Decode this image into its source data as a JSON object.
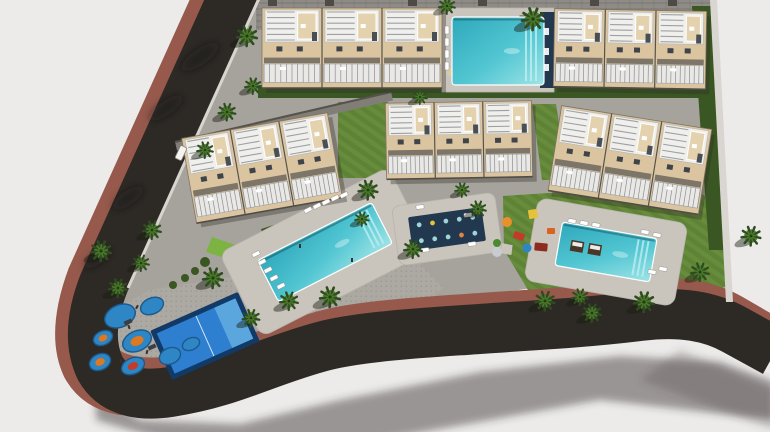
{
  "meta": {
    "canvas": {
      "w": 770,
      "h": 432
    },
    "subject": "aerial-3d-render-residential-complex"
  },
  "scene": {
    "colors": {
      "bg": "#ECEBE9",
      "road": "#2D2925",
      "sidewalk": "#96594C",
      "curb": "#D8D4CE",
      "paving": "#A6A29C",
      "plaza": "#ACA8A2",
      "deck": "#C9C5BD",
      "roofband": "#8F8B86",
      "facade": "#DBC5A1",
      "facadeLight": "#E4D2AF",
      "roofdeck": "#F0EFEB",
      "stripe": "#9BA1A6",
      "windowc": "#3F444A",
      "railing": "#E9E8E4",
      "lawn": "#5E8236",
      "lawnLight": "#6E9440",
      "lawnBright": "#7CB342",
      "hedge": "#3A5622",
      "palmDark": "#2E4D1F",
      "palmLight": "#4C7A2B",
      "waterDeep": "#2FA8BC",
      "waterMid": "#52C6D2",
      "waterLight": "#9FE4E6",
      "navy": "#22384E",
      "courtBlue": "#2E7FD0",
      "courtFrame": "#123A66",
      "courtLight": "#5CA6DE",
      "circleBlue": "#2F86C4",
      "wall": "#D9D6D1",
      "shadow": "rgba(50,46,42,0.45)",
      "kiosk": "#6F4A2E",
      "platform": "#4A3726"
    },
    "buildings": [
      {
        "id": "top-left",
        "cx": 352,
        "cy": 48,
        "w": 180,
        "h": 80,
        "rot": 0,
        "modules": 3
      },
      {
        "id": "top-right",
        "cx": 630,
        "cy": 49,
        "w": 152,
        "h": 78,
        "rot": 1,
        "modules": 3
      },
      {
        "id": "mid-left",
        "cx": 262,
        "cy": 168,
        "w": 148,
        "h": 86,
        "rot": -10,
        "modules": 3
      },
      {
        "id": "mid-center",
        "cx": 459,
        "cy": 140,
        "w": 146,
        "h": 76,
        "rot": -1,
        "modules": 3
      },
      {
        "id": "mid-right",
        "cx": 630,
        "cy": 160,
        "w": 152,
        "h": 86,
        "rot": 9,
        "modules": 3
      }
    ],
    "pools": [
      {
        "id": "north",
        "cx": 498,
        "cy": 51,
        "l": 92,
        "w": 68,
        "rot": 0,
        "deck": false,
        "platforms": false
      },
      {
        "id": "central",
        "cx": 325,
        "cy": 252,
        "l": 128,
        "w": 46,
        "rot": -27,
        "deck": true,
        "deckL": 190,
        "deckW": 94,
        "platforms": false
      },
      {
        "id": "south",
        "cx": 606,
        "cy": 252,
        "l": 96,
        "w": 44,
        "rot": 10,
        "deck": true,
        "deckL": 152,
        "deckW": 84,
        "platforms": true
      }
    ],
    "court": {
      "cx": 205,
      "cy": 336,
      "l": 96,
      "w": 54,
      "rot": -24
    },
    "games_pad": {
      "cx": 447,
      "cy": 229,
      "l": 74,
      "w": 34,
      "rot": -8,
      "deckL": 104,
      "deckW": 60,
      "cols": 5,
      "rows": 2
    },
    "palms": [
      [
        247,
        36,
        1
      ],
      [
        253,
        86,
        0.8
      ],
      [
        227,
        112,
        0.85
      ],
      [
        205,
        150,
        0.8
      ],
      [
        152,
        230,
        0.9
      ],
      [
        101,
        251,
        1
      ],
      [
        118,
        288,
        0.9
      ],
      [
        141,
        263,
        0.8
      ],
      [
        533,
        19,
        1.1
      ],
      [
        447,
        6,
        0.8
      ],
      [
        420,
        97,
        0.7
      ],
      [
        368,
        190,
        0.95
      ],
      [
        330,
        297,
        1
      ],
      [
        289,
        301,
        0.9
      ],
      [
        251,
        318,
        0.85
      ],
      [
        213,
        278,
        1
      ],
      [
        413,
        249,
        0.9
      ],
      [
        478,
        209,
        0.8
      ],
      [
        545,
        301,
        0.95
      ],
      [
        592,
        313,
        0.9
      ],
      [
        644,
        302,
        1
      ],
      [
        700,
        272,
        0.9
      ],
      [
        751,
        236,
        0.95
      ],
      [
        580,
        297,
        0.8
      ],
      [
        462,
        190,
        0.7
      ],
      [
        362,
        219,
        0.7
      ]
    ],
    "loungers": [
      [
        447,
        30,
        90
      ],
      [
        447,
        42,
        90
      ],
      [
        447,
        54,
        90
      ],
      [
        447,
        66,
        90
      ],
      [
        262,
        262,
        -27
      ],
      [
        268,
        270,
        -27
      ],
      [
        274,
        278,
        -27
      ],
      [
        281,
        286,
        -27
      ],
      [
        256,
        254,
        -27
      ],
      [
        317,
        206,
        -27
      ],
      [
        326,
        202,
        -27
      ],
      [
        335,
        198,
        -27
      ],
      [
        344,
        195,
        -27
      ],
      [
        308,
        210,
        -27
      ],
      [
        572,
        221,
        10
      ],
      [
        584,
        223,
        10
      ],
      [
        596,
        225,
        10
      ],
      [
        645,
        232,
        10
      ],
      [
        657,
        235,
        10
      ],
      [
        652,
        272,
        10
      ],
      [
        663,
        269,
        10
      ],
      [
        420,
        207,
        -8
      ],
      [
        468,
        215,
        -8
      ],
      [
        425,
        250,
        -8
      ],
      [
        472,
        244,
        -8
      ]
    ],
    "play_circles": [
      [
        120,
        316,
        16,
        11,
        ""
      ],
      [
        152,
        306,
        12,
        8,
        ""
      ],
      [
        103,
        338,
        10,
        7,
        "#E07820"
      ],
      [
        137,
        341,
        15,
        10,
        "#E07820"
      ],
      [
        100,
        362,
        11,
        8,
        "#E07820"
      ],
      [
        133,
        366,
        12,
        8,
        "#C33B2B"
      ],
      [
        170,
        356,
        11,
        8,
        ""
      ],
      [
        191,
        344,
        9,
        6,
        ""
      ]
    ],
    "play_structures": [
      [
        128,
        322,
        -24
      ],
      [
        152,
        347,
        -24
      ]
    ],
    "play_items": [
      {
        "t": "dot",
        "x": 507,
        "y": 222,
        "r": 5,
        "c": "#E8912A"
      },
      {
        "t": "rect",
        "x": 519,
        "y": 236,
        "w": 11,
        "h": 7,
        "rot": 20,
        "c": "#C23B2A"
      },
      {
        "t": "rect",
        "x": 533,
        "y": 214,
        "w": 9,
        "h": 9,
        "rot": -10,
        "c": "#E8C13A"
      },
      {
        "t": "rect",
        "x": 541,
        "y": 247,
        "w": 13,
        "h": 8,
        "rot": 5,
        "c": "#8E2B20"
      },
      {
        "t": "dot",
        "x": 497,
        "y": 243,
        "r": 4,
        "c": "#4C8A2F"
      },
      {
        "t": "dot",
        "x": 527,
        "y": 248,
        "r": 4.5,
        "c": "#2F86C4"
      },
      {
        "t": "rect",
        "x": 551,
        "y": 231,
        "w": 8,
        "h": 6,
        "rot": 0,
        "c": "#D9641F"
      },
      {
        "t": "dot",
        "x": 497,
        "y": 252,
        "r": 5,
        "c": "#C9CCCF"
      }
    ],
    "figures": [
      [
        129,
        327,
        -20
      ],
      [
        147,
        352,
        15
      ],
      [
        121,
        361,
        0
      ],
      [
        137,
        307,
        30
      ],
      [
        352,
        260,
        0
      ],
      [
        300,
        246,
        0
      ]
    ],
    "vehicle": {
      "x": 181,
      "y": 153,
      "rot": 25,
      "w": 7,
      "h": 14
    },
    "chimneys": [
      [
        268,
        0
      ],
      [
        325,
        0
      ],
      [
        408,
        0
      ],
      [
        478,
        0
      ],
      [
        590,
        0
      ],
      [
        668,
        0
      ]
    ]
  }
}
